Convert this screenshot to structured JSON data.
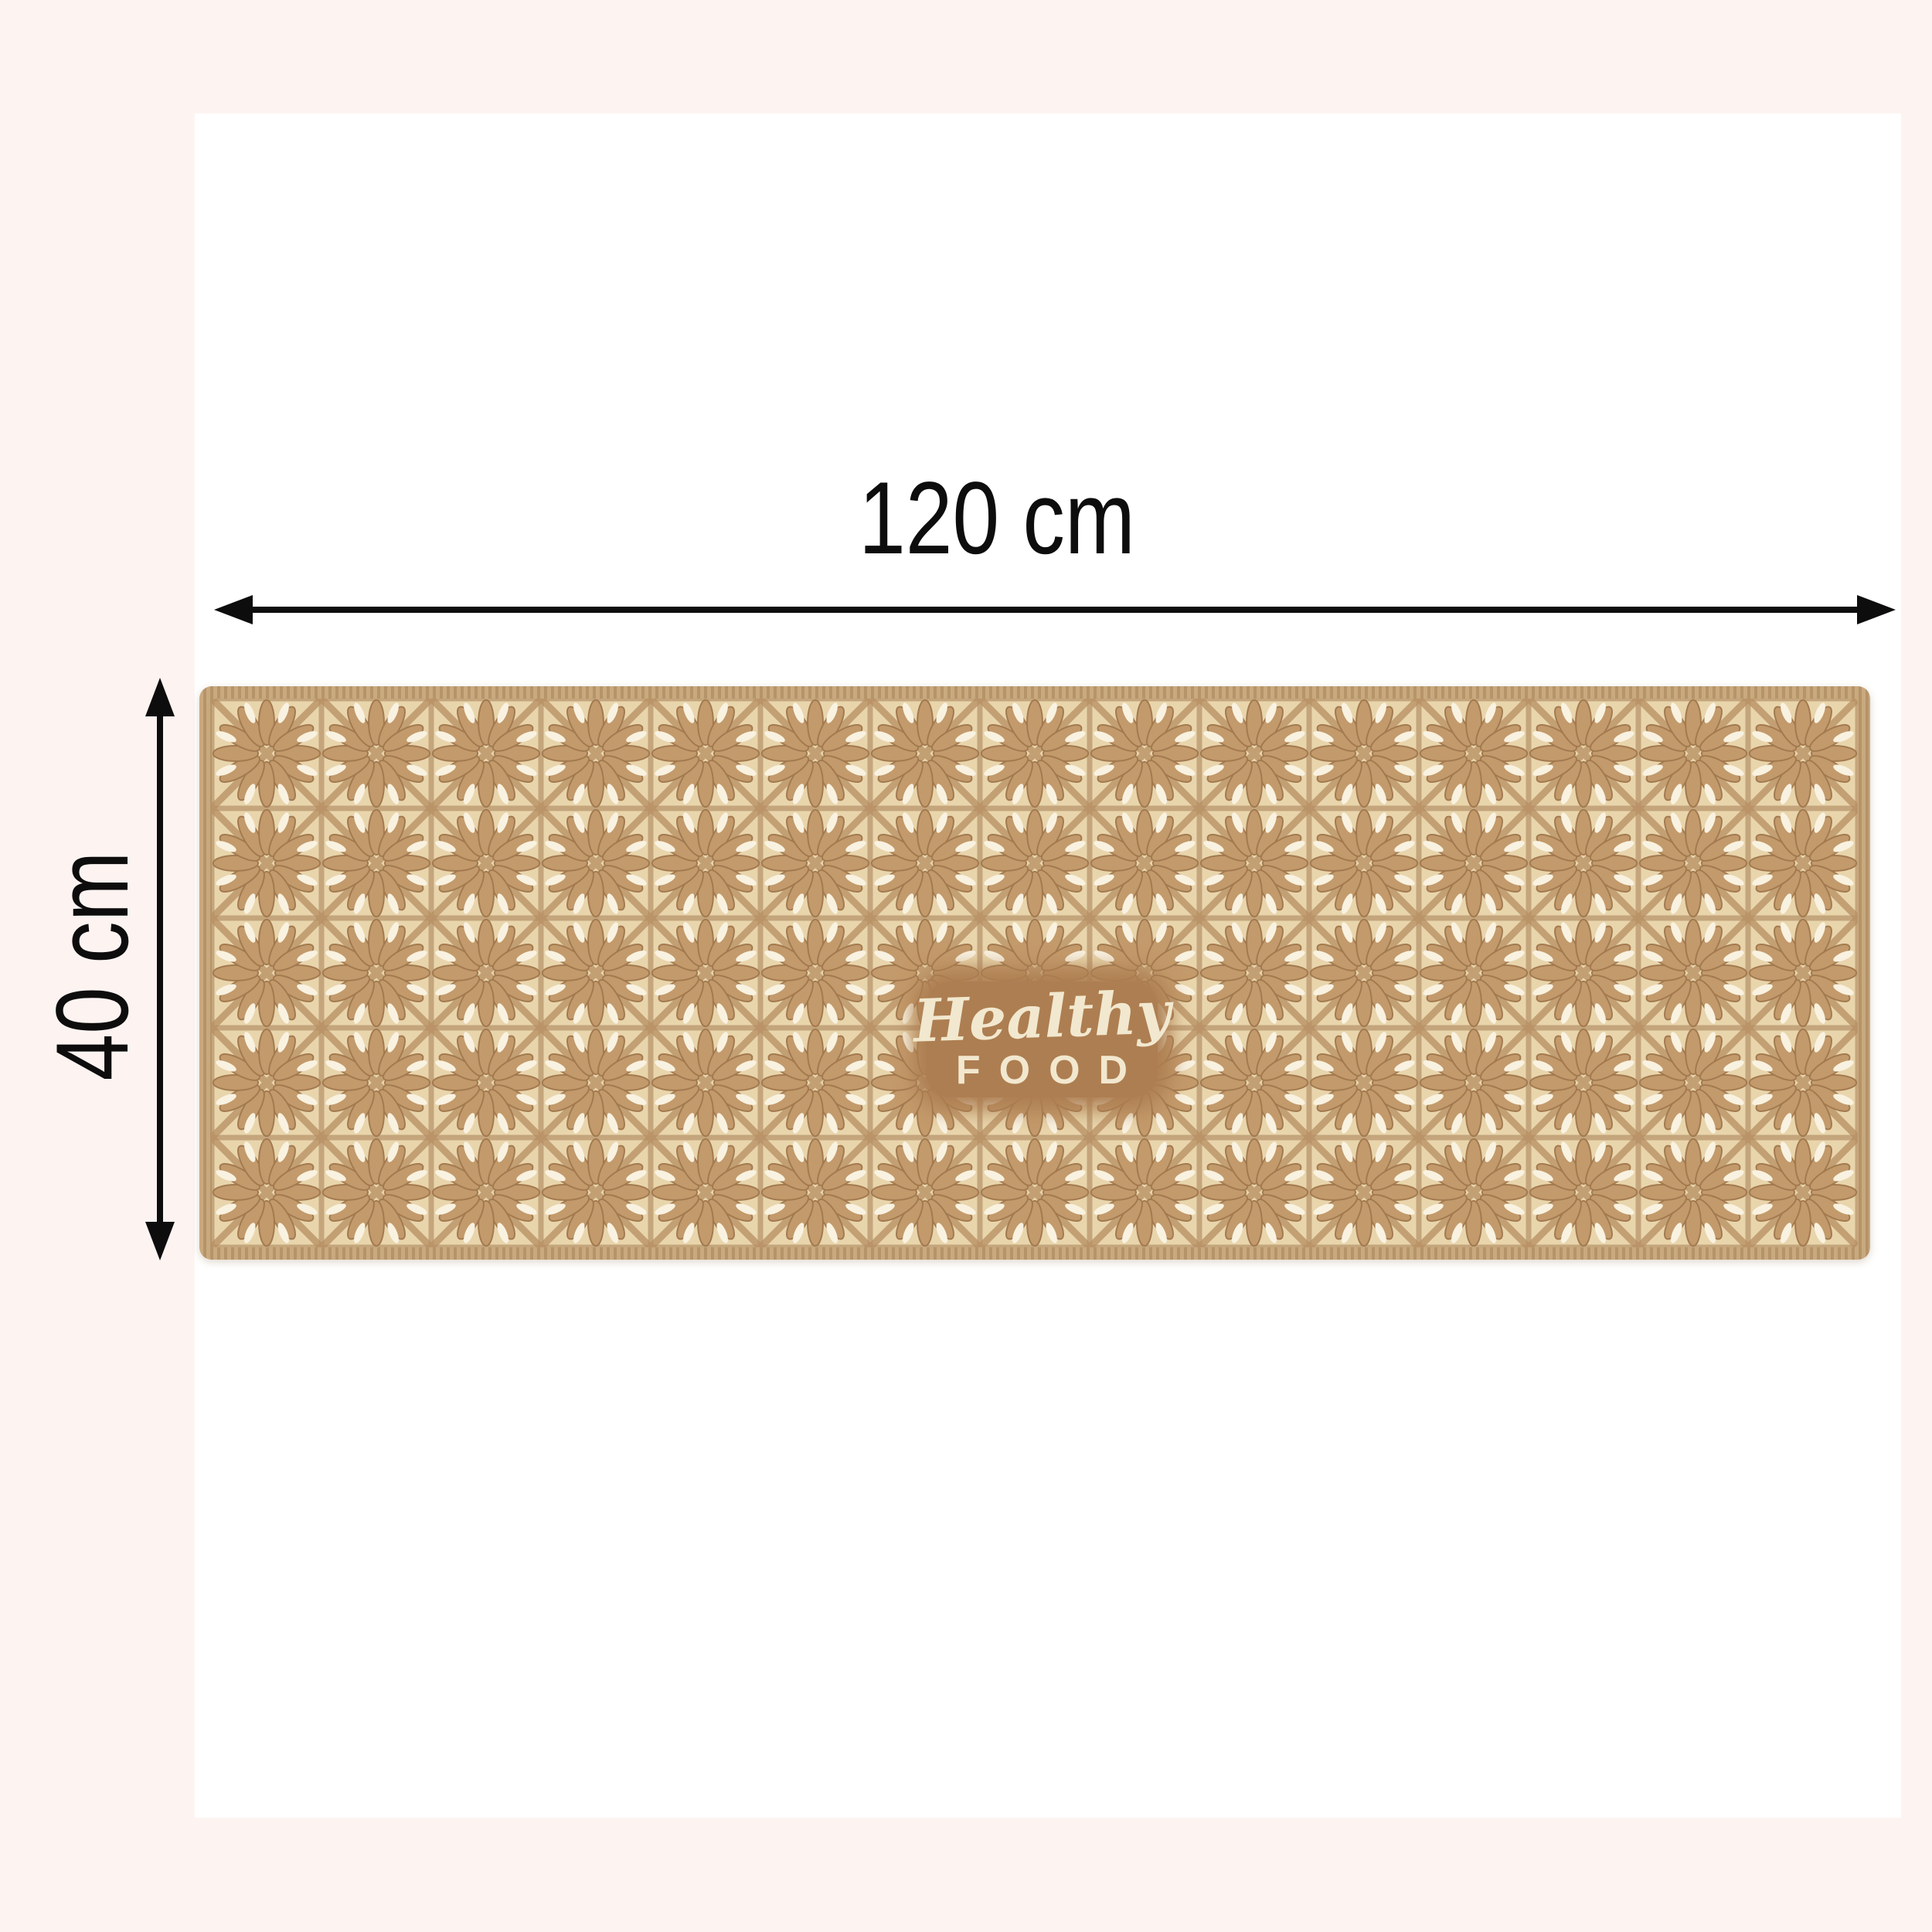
{
  "page": {
    "description": "Product dimension photo of a beige kitchen runner mat",
    "canvas_bg": "#fdf4f2",
    "photo_bg": "#ffffff"
  },
  "annotations": {
    "arrow_color": "#0e0d0d",
    "width": {
      "label": "120 cm"
    },
    "height": {
      "label": "40 cm"
    }
  },
  "rug": {
    "print": {
      "line1": "Healthy",
      "line2": "FOOD"
    },
    "colors": {
      "serge": "#c9a97e",
      "serge_dark": "#b6946a",
      "seam": "#8d6b44",
      "field": "#e9d5ac",
      "grid": "#a0764c",
      "diagonal": "#b78f61",
      "petal": "#c39a6b",
      "petal_dark": "#a37a4f",
      "accent": "#f9f2e1",
      "patch": "#ad7e51",
      "patch_text": "#f2e8cf"
    },
    "pattern": {
      "tile_size": 142,
      "petal_count": 12,
      "accent_count": 8
    }
  }
}
